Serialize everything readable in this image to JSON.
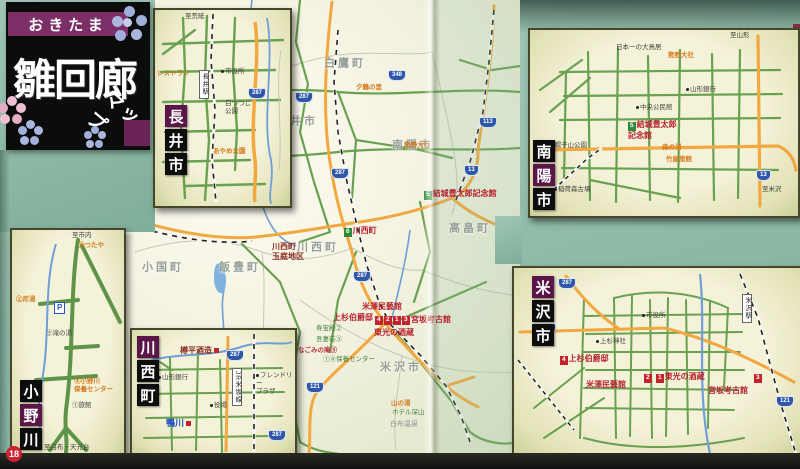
{
  "page": {
    "number": "18"
  },
  "title": {
    "ribbon": "おきたま",
    "main": "雛回廊",
    "sub": "マップ"
  },
  "colors": {
    "teal_bg": "#8fbcab",
    "road_green": "#68a14f",
    "road_orange": "#f2a840",
    "river_blue": "#6f9fd6",
    "site_red": "#c3232d",
    "site_green": "#2c8a38",
    "shield_blue": "#2e57aa",
    "title_purple": "#7b2f66"
  },
  "main_map": {
    "labels": [
      {
        "t": "白鷹町",
        "k": "muni",
        "c": 1,
        "x": 345,
        "y": 64
      },
      {
        "t": "長井市",
        "k": "muni",
        "c": 1,
        "x": 297,
        "y": 122
      },
      {
        "t": "南陽市",
        "k": "muni",
        "c": 1,
        "x": 413,
        "y": 146
      },
      {
        "t": "小国町",
        "k": "muni",
        "c": 1,
        "x": 163,
        "y": 268
      },
      {
        "t": "飯豊町",
        "k": "muni",
        "c": 1,
        "x": 240,
        "y": 268
      },
      {
        "t": "川西町",
        "k": "muni",
        "c": 1,
        "x": 318,
        "y": 248
      },
      {
        "t": "高畠町",
        "k": "muni",
        "c": 1,
        "x": 470,
        "y": 229
      },
      {
        "t": "米沢市",
        "k": "muni",
        "c": 1,
        "x": 401,
        "y": 368
      },
      {
        "t": "結城豊太郎記念館",
        "k": "red",
        "box": {
          "n": "5",
          "c": "g"
        },
        "x": 424,
        "y": 189
      },
      {
        "t": "川西町",
        "k": "red",
        "box": {
          "n": "6",
          "c": "g"
        },
        "x": 344,
        "y": 226
      },
      {
        "t": "川西町\n玉庭地区",
        "k": "darkred",
        "x": 272,
        "y": 242
      },
      {
        "t": "米澤民藝館",
        "k": "red",
        "x": 362,
        "y": 302
      },
      {
        "t": "上杉伯爵邸",
        "k": "red",
        "x": 333,
        "y": 313
      },
      {
        "t": "",
        "box": {
          "n": "4",
          "c": "r"
        },
        "k": "red",
        "x": 375,
        "y": 314
      },
      {
        "t": "",
        "box": {
          "n": "2",
          "c": "r"
        },
        "k": "red",
        "x": 384,
        "y": 314
      },
      {
        "t": "",
        "box": {
          "n": "1",
          "c": "r"
        },
        "k": "red",
        "x": 393,
        "y": 314
      },
      {
        "t": "",
        "box": {
          "n": "3",
          "c": "r"
        },
        "k": "red",
        "x": 402,
        "y": 314
      },
      {
        "t": "宮坂考古館",
        "k": "red",
        "x": 411,
        "y": 315
      },
      {
        "t": "東光の酒蔵",
        "k": "red",
        "x": 374,
        "y": 328
      },
      {
        "t": "寿宝殿②",
        "k": "greens",
        "x": 316,
        "y": 325
      },
      {
        "t": "吾妻荘③",
        "k": "greens",
        "x": 316,
        "y": 336
      },
      {
        "t": "なごみの庵⑤",
        "k": "reds",
        "x": 298,
        "y": 347
      },
      {
        "t": "①④保養センター",
        "k": "greens",
        "x": 323,
        "y": 356
      },
      {
        "t": "山の湯",
        "k": "orange",
        "x": 391,
        "y": 400
      },
      {
        "t": "ホテル深山",
        "k": "greens",
        "x": 392,
        "y": 409
      },
      {
        "t": "白布温泉",
        "k": "gray",
        "x": 390,
        "y": 421
      },
      {
        "t": "夕鶴の里",
        "k": "orange",
        "x": 356,
        "y": 84
      },
      {
        "t": "熊野大社",
        "k": "orange",
        "x": 404,
        "y": 142
      },
      {
        "t": "348",
        "k": "shield",
        "x": 388,
        "y": 70
      },
      {
        "t": "287",
        "k": "shield",
        "x": 295,
        "y": 92
      },
      {
        "t": "113",
        "k": "shield",
        "x": 479,
        "y": 117
      },
      {
        "t": "13",
        "k": "shield",
        "x": 464,
        "y": 165
      },
      {
        "t": "287",
        "k": "shield",
        "x": 331,
        "y": 168
      },
      {
        "t": "287",
        "k": "shield",
        "x": 353,
        "y": 271
      },
      {
        "t": "121",
        "k": "shield",
        "x": 306,
        "y": 382
      }
    ]
  },
  "insets": [
    {
      "id": "nagai",
      "box": {
        "x": 153,
        "y": 8,
        "w": 135,
        "h": 196
      },
      "title": {
        "x": 10,
        "y": 95,
        "chars": [
          {
            "ch": "長",
            "bg": "p"
          },
          {
            "ch": "井",
            "bg": "k"
          },
          {
            "ch": "市",
            "bg": "k"
          }
        ]
      },
      "labels": [
        {
          "t": "至荒砥",
          "k": "tiny",
          "x": 30,
          "y": 3
        },
        {
          "t": "レストラン",
          "k": "orange",
          "x": 2,
          "y": 60
        },
        {
          "t": "市役所",
          "k": "tiny",
          "dot": 1,
          "x": 66,
          "y": 58
        },
        {
          "t": "長井駅",
          "k": "vbox",
          "v": 1,
          "x": 44,
          "y": 60
        },
        {
          "t": "白つつじ\n公園",
          "k": "tiny",
          "x": 70,
          "y": 90
        },
        {
          "t": "あやめ公園",
          "k": "orange",
          "x": 58,
          "y": 138
        },
        {
          "t": "287",
          "k": "shield",
          "x": 93,
          "y": 78
        }
      ]
    },
    {
      "id": "nanyo",
      "box": {
        "x": 528,
        "y": 28,
        "w": 268,
        "h": 186
      },
      "title": {
        "x": 3,
        "y": 110,
        "chars": [
          {
            "ch": "南",
            "bg": "k"
          },
          {
            "ch": "陽",
            "bg": "p"
          },
          {
            "ch": "市",
            "bg": "k"
          }
        ]
      },
      "labels": [
        {
          "t": "至山形",
          "k": "tiny",
          "x": 200,
          "y": 2
        },
        {
          "t": "熊野大社",
          "k": "orange",
          "x": 138,
          "y": 22
        },
        {
          "t": "日本一の大鳥居",
          "k": "tiny",
          "x": 86,
          "y": 14
        },
        {
          "t": "山形銀行",
          "k": "tiny",
          "dot": 1,
          "x": 156,
          "y": 56
        },
        {
          "t": "中央公民館",
          "k": "tiny",
          "dot": 1,
          "x": 106,
          "y": 74
        },
        {
          "t": "結城豊太郎\n記念館",
          "k": "red",
          "box": {
            "n": "5",
            "c": "g"
          },
          "x": 98,
          "y": 90
        },
        {
          "t": "森の湯",
          "k": "orange",
          "x": 132,
          "y": 114
        },
        {
          "t": "竹屋旅館",
          "k": "orange",
          "x": 136,
          "y": 126
        },
        {
          "t": "烏帽子山公園",
          "k": "tiny",
          "dot": 1,
          "x": 14,
          "y": 112
        },
        {
          "t": "稲荷森古墳",
          "k": "tiny",
          "dot": 1,
          "x": 24,
          "y": 156
        },
        {
          "t": "至米沢",
          "k": "tiny",
          "x": 232,
          "y": 156
        },
        {
          "t": "13",
          "k": "shield",
          "x": 226,
          "y": 140
        }
      ]
    },
    {
      "id": "yonezawa",
      "box": {
        "x": 512,
        "y": 266,
        "w": 288,
        "h": 187
      },
      "title": {
        "x": 18,
        "y": 8,
        "chars": [
          {
            "ch": "米",
            "bg": "p"
          },
          {
            "ch": "沢",
            "bg": "k"
          },
          {
            "ch": "市",
            "bg": "k"
          }
        ]
      },
      "labels": [
        {
          "t": "287",
          "k": "shield",
          "x": 44,
          "y": 10
        },
        {
          "t": "121",
          "k": "shield",
          "x": 24,
          "y": 55
        },
        {
          "t": "121",
          "k": "shield",
          "x": 262,
          "y": 128
        },
        {
          "t": "米沢駅",
          "k": "vbox",
          "v": 1,
          "x": 228,
          "y": 26
        },
        {
          "t": "市役所",
          "k": "tiny",
          "dot": 1,
          "x": 128,
          "y": 44
        },
        {
          "t": "上杉神社",
          "k": "tiny",
          "dot": 1,
          "x": 82,
          "y": 70
        },
        {
          "t": "上杉伯爵邸",
          "k": "red",
          "box": {
            "n": "4",
            "c": "r"
          },
          "x": 46,
          "y": 86
        },
        {
          "t": "米澤民藝館",
          "k": "red",
          "x": 72,
          "y": 112
        },
        {
          "t": "",
          "box": {
            "n": "2",
            "c": "r"
          },
          "k": "red",
          "x": 130,
          "y": 104
        },
        {
          "t": "東光の酒蔵",
          "k": "red",
          "box": {
            "n": "1",
            "c": "r"
          },
          "x": 142,
          "y": 104
        },
        {
          "t": "",
          "box": {
            "n": "3",
            "c": "r"
          },
          "k": "red",
          "x": 240,
          "y": 104
        },
        {
          "t": "宮坂考古館",
          "k": "red",
          "x": 194,
          "y": 118
        }
      ]
    },
    {
      "id": "onogawa",
      "box": {
        "x": 10,
        "y": 228,
        "w": 112,
        "h": 225
      },
      "title": {
        "x": 8,
        "y": 150,
        "chars": [
          {
            "ch": "小",
            "bg": "k"
          },
          {
            "ch": "野",
            "bg": "p"
          },
          {
            "ch": "川",
            "bg": "k"
          }
        ]
      },
      "labels": [
        {
          "t": "至市内",
          "k": "tiny",
          "x": 60,
          "y": 2
        },
        {
          "t": "⑤つたや",
          "k": "orange",
          "x": 66,
          "y": 12
        },
        {
          "t": "②尼湯",
          "k": "orange",
          "x": 4,
          "y": 66
        },
        {
          "t": "P",
          "k": "pbox",
          "x": 42,
          "y": 72
        },
        {
          "t": "③滝の湯",
          "k": "tiny",
          "x": 34,
          "y": 100
        },
        {
          "t": "④小野川\n保養センター",
          "k": "orange",
          "x": 62,
          "y": 148
        },
        {
          "t": "①旅館",
          "k": "tiny",
          "x": 60,
          "y": 172
        },
        {
          "t": "至白布・天元台",
          "k": "tiny",
          "x": 32,
          "y": 214
        }
      ]
    },
    {
      "id": "kawanishi",
      "box": {
        "x": 130,
        "y": 328,
        "w": 163,
        "h": 125
      },
      "title": {
        "x": 5,
        "y": 6,
        "chars": [
          {
            "ch": "川",
            "bg": "p"
          },
          {
            "ch": "西",
            "bg": "k"
          },
          {
            "ch": "町",
            "bg": "k"
          }
        ]
      },
      "labels": [
        {
          "t": "樽平酒造",
          "k": "darkred",
          "mark": 1,
          "x": 48,
          "y": 16
        },
        {
          "t": "鴨川",
          "k": "blueb",
          "mark": 1,
          "x": 34,
          "y": 88
        },
        {
          "t": "役場",
          "k": "tiny",
          "dot": 1,
          "x": 78,
          "y": 72
        },
        {
          "t": "フレンドリー\nプラザ",
          "k": "tiny",
          "dot": 1,
          "x": 124,
          "y": 42
        },
        {
          "t": "山形銀行",
          "k": "tiny",
          "dot": 1,
          "x": 26,
          "y": 44
        },
        {
          "t": "JR米坂線",
          "k": "vbox",
          "v": 1,
          "x": 100,
          "y": 38
        },
        {
          "t": "287",
          "k": "shield",
          "x": 94,
          "y": 20
        },
        {
          "t": "287",
          "k": "shield",
          "x": 136,
          "y": 100
        }
      ]
    }
  ]
}
